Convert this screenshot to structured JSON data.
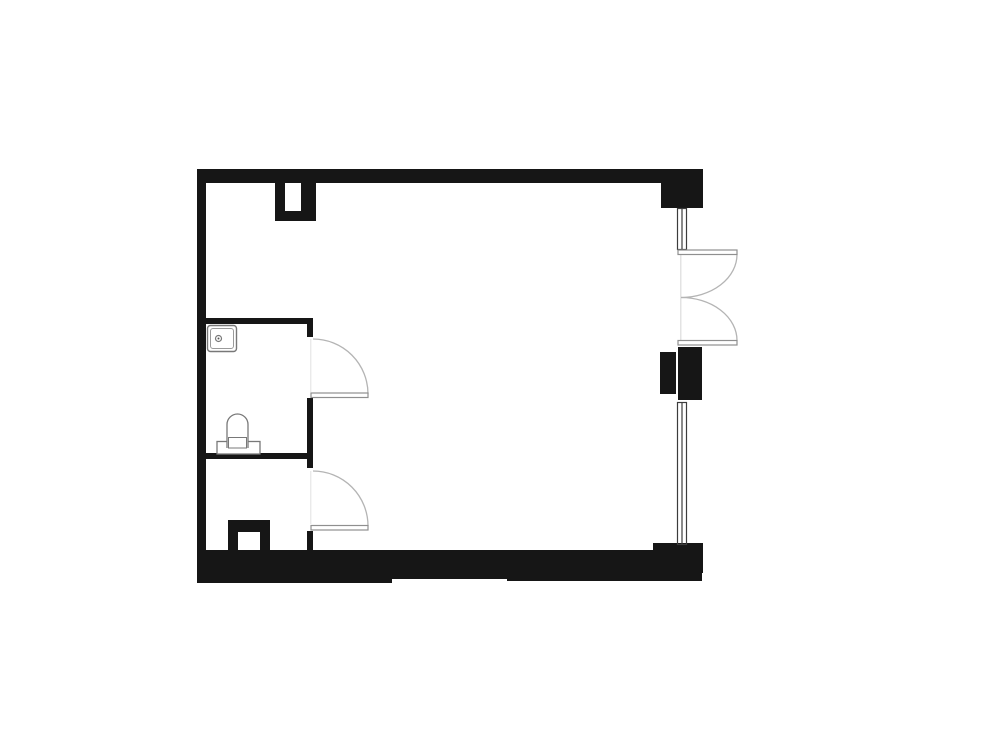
{
  "canvas": {
    "width": 1000,
    "height": 750,
    "background": "#ffffff"
  },
  "floor_plan": {
    "colors": {
      "wall": "#161616",
      "window_stroke": "#3c3c3c",
      "door_arc": "#b4b4b4",
      "door_leaf_stroke": "#8f8f8f",
      "fixture_stroke": "#787878",
      "faint_line": "#dcdcdc"
    },
    "shapes": [
      {
        "name": "top-wall",
        "type": "rect",
        "attrs": {
          "x": 197,
          "y": 169,
          "width": 506,
          "height": 14,
          "fill": "#161616"
        }
      },
      {
        "name": "top-right-corner-block",
        "type": "rect",
        "attrs": {
          "x": 661,
          "y": 169,
          "width": 42,
          "height": 39,
          "fill": "#161616"
        }
      },
      {
        "name": "left-wall",
        "type": "rect",
        "attrs": {
          "x": 197,
          "y": 169,
          "width": 9,
          "height": 414,
          "fill": "#161616"
        }
      },
      {
        "name": "bathroom-top-wall",
        "type": "rect",
        "attrs": {
          "x": 197,
          "y": 318,
          "width": 116,
          "height": 6,
          "fill": "#161616"
        }
      },
      {
        "name": "bathroom-bottom-wall",
        "type": "rect",
        "attrs": {
          "x": 197,
          "y": 453,
          "width": 116,
          "height": 6,
          "fill": "#161616"
        }
      },
      {
        "name": "partition-stub-upper",
        "type": "rect",
        "attrs": {
          "x": 307,
          "y": 318,
          "width": 6,
          "height": 19,
          "fill": "#161616"
        }
      },
      {
        "name": "partition-wall-mid",
        "type": "rect",
        "attrs": {
          "x": 307,
          "y": 398,
          "width": 6,
          "height": 70,
          "fill": "#161616"
        }
      },
      {
        "name": "partition-stub-lower",
        "type": "rect",
        "attrs": {
          "x": 307,
          "y": 531,
          "width": 6,
          "height": 21,
          "fill": "#161616"
        }
      },
      {
        "name": "duct-top-left-leg",
        "type": "rect",
        "attrs": {
          "x": 275,
          "y": 183,
          "width": 10,
          "height": 38,
          "fill": "#161616"
        }
      },
      {
        "name": "duct-top-right-leg",
        "type": "rect",
        "attrs": {
          "x": 301,
          "y": 183,
          "width": 15,
          "height": 38,
          "fill": "#161616"
        }
      },
      {
        "name": "duct-top-bottom-bar",
        "type": "rect",
        "attrs": {
          "x": 275,
          "y": 211,
          "width": 41,
          "height": 10,
          "fill": "#161616"
        }
      },
      {
        "name": "duct-bottom-cap",
        "type": "rect",
        "attrs": {
          "x": 228,
          "y": 520,
          "width": 42,
          "height": 12,
          "fill": "#161616"
        }
      },
      {
        "name": "duct-bottom-left-leg",
        "type": "rect",
        "attrs": {
          "x": 228,
          "y": 520,
          "width": 10,
          "height": 31,
          "fill": "#161616"
        }
      },
      {
        "name": "duct-bottom-right-leg",
        "type": "rect",
        "attrs": {
          "x": 260,
          "y": 520,
          "width": 10,
          "height": 31,
          "fill": "#161616"
        }
      },
      {
        "name": "right-pier-inner",
        "type": "rect",
        "attrs": {
          "x": 660,
          "y": 352,
          "width": 16,
          "height": 42,
          "fill": "#161616"
        }
      },
      {
        "name": "right-pier-outer",
        "type": "rect",
        "attrs": {
          "x": 678,
          "y": 347,
          "width": 24,
          "height": 53,
          "fill": "#161616"
        }
      },
      {
        "name": "bottom-right-corner-block",
        "type": "rect",
        "attrs": {
          "x": 653,
          "y": 543,
          "width": 50,
          "height": 30,
          "fill": "#161616"
        }
      },
      {
        "name": "bottom-wall-main",
        "type": "rect",
        "attrs": {
          "x": 197,
          "y": 550,
          "width": 458,
          "height": 23,
          "fill": "#161616"
        }
      },
      {
        "name": "bottom-wall-ledge-left",
        "type": "rect",
        "attrs": {
          "x": 197,
          "y": 572,
          "width": 195,
          "height": 11,
          "fill": "#161616"
        }
      },
      {
        "name": "bottom-wall-ledge-mid",
        "type": "rect",
        "attrs": {
          "x": 392,
          "y": 572,
          "width": 115,
          "height": 7,
          "fill": "#161616"
        }
      },
      {
        "name": "bottom-wall-ledge-right",
        "type": "rect",
        "attrs": {
          "x": 507,
          "y": 572,
          "width": 195,
          "height": 9,
          "fill": "#161616"
        }
      },
      {
        "name": "window-upper-line-left",
        "type": "line",
        "attrs": {
          "x1": 677.5,
          "y1": 208,
          "x2": 677.5,
          "y2": 250,
          "stroke": "#3c3c3c",
          "stroke-width": 1.2
        }
      },
      {
        "name": "window-upper-line-mid",
        "type": "line",
        "attrs": {
          "x1": 682,
          "y1": 208,
          "x2": 682,
          "y2": 250,
          "stroke": "#3c3c3c",
          "stroke-width": 1.2
        }
      },
      {
        "name": "window-upper-line-right",
        "type": "line",
        "attrs": {
          "x1": 686.5,
          "y1": 208,
          "x2": 686.5,
          "y2": 250,
          "stroke": "#3c3c3c",
          "stroke-width": 1.2
        }
      },
      {
        "name": "window-upper-cap-top",
        "type": "line",
        "attrs": {
          "x1": 677,
          "y1": 208.5,
          "x2": 687,
          "y2": 208.5,
          "stroke": "#3c3c3c",
          "stroke-width": 1.2
        }
      },
      {
        "name": "window-upper-cap-bottom",
        "type": "line",
        "attrs": {
          "x1": 677,
          "y1": 249.5,
          "x2": 687,
          "y2": 249.5,
          "stroke": "#3c3c3c",
          "stroke-width": 1.2
        }
      },
      {
        "name": "window-lower-line-left",
        "type": "line",
        "attrs": {
          "x1": 677.5,
          "y1": 402,
          "x2": 677.5,
          "y2": 545,
          "stroke": "#3c3c3c",
          "stroke-width": 1.2
        }
      },
      {
        "name": "window-lower-line-mid",
        "type": "line",
        "attrs": {
          "x1": 682,
          "y1": 402,
          "x2": 682,
          "y2": 545,
          "stroke": "#3c3c3c",
          "stroke-width": 1.2
        }
      },
      {
        "name": "window-lower-line-right",
        "type": "line",
        "attrs": {
          "x1": 686.5,
          "y1": 402,
          "x2": 686.5,
          "y2": 545,
          "stroke": "#3c3c3c",
          "stroke-width": 1.2
        }
      },
      {
        "name": "window-lower-cap-top",
        "type": "line",
        "attrs": {
          "x1": 677,
          "y1": 402.5,
          "x2": 687,
          "y2": 402.5,
          "stroke": "#3c3c3c",
          "stroke-width": 1.2
        }
      },
      {
        "name": "window-lower-cap-bottom",
        "type": "line",
        "attrs": {
          "x1": 677,
          "y1": 544.5,
          "x2": 687,
          "y2": 544.5,
          "stroke": "#3c3c3c",
          "stroke-width": 1.2
        }
      },
      {
        "name": "french-door-threshold-line",
        "type": "line",
        "attrs": {
          "x1": 680.8,
          "y1": 255,
          "x2": 680.8,
          "y2": 340,
          "stroke": "#dcdcdc",
          "stroke-width": 1.2
        }
      },
      {
        "name": "french-door-top-arc",
        "type": "path",
        "attrs": {
          "d": "M 737 254.5 A 56 43 0 0 1 681 297.5",
          "fill": "none",
          "stroke": "#b4b4b4",
          "stroke-width": 1.3
        }
      },
      {
        "name": "french-door-bottom-arc",
        "type": "path",
        "attrs": {
          "d": "M 737 340.5 A 56 43 0 0 0 681 297.5",
          "fill": "none",
          "stroke": "#b4b4b4",
          "stroke-width": 1.3
        }
      },
      {
        "name": "french-door-top-leaf",
        "type": "rect",
        "attrs": {
          "x": 678,
          "y": 250,
          "width": 59,
          "height": 4.5,
          "fill": "#ffffff",
          "stroke": "#8f8f8f",
          "stroke-width": 1.2
        }
      },
      {
        "name": "french-door-bottom-leaf",
        "type": "rect",
        "attrs": {
          "x": 678,
          "y": 340.5,
          "width": 59,
          "height": 4.5,
          "fill": "#ffffff",
          "stroke": "#8f8f8f",
          "stroke-width": 1.2
        }
      },
      {
        "name": "bath-door-closed-line",
        "type": "line",
        "attrs": {
          "x1": 310.8,
          "y1": 339,
          "x2": 310.8,
          "y2": 392,
          "stroke": "#e2e2e2",
          "stroke-width": 1
        }
      },
      {
        "name": "bath-door-arc",
        "type": "path",
        "attrs": {
          "d": "M 313 339 A 55 55 0 0 1 368 394",
          "fill": "none",
          "stroke": "#b4b4b4",
          "stroke-width": 1.3
        }
      },
      {
        "name": "bath-door-leaf",
        "type": "rect",
        "attrs": {
          "x": 311,
          "y": 393,
          "width": 57,
          "height": 4.5,
          "fill": "#ffffff",
          "stroke": "#8f8f8f",
          "stroke-width": 1.2
        }
      },
      {
        "name": "wc-door-closed-line",
        "type": "line",
        "attrs": {
          "x1": 310.8,
          "y1": 471,
          "x2": 310.8,
          "y2": 524,
          "stroke": "#e2e2e2",
          "stroke-width": 1
        }
      },
      {
        "name": "wc-door-arc",
        "type": "path",
        "attrs": {
          "d": "M 313 471 A 55 55 0 0 1 368 526",
          "fill": "none",
          "stroke": "#b4b4b4",
          "stroke-width": 1.3
        }
      },
      {
        "name": "wc-door-leaf",
        "type": "rect",
        "attrs": {
          "x": 311,
          "y": 525.5,
          "width": 57,
          "height": 4.5,
          "fill": "#ffffff",
          "stroke": "#8f8f8f",
          "stroke-width": 1.2
        }
      },
      {
        "name": "sink-outer",
        "type": "rect",
        "attrs": {
          "x": 207.5,
          "y": 325.5,
          "width": 29,
          "height": 26,
          "rx": 3,
          "fill": "#ffffff",
          "stroke": "#787878",
          "stroke-width": 1.4
        }
      },
      {
        "name": "sink-inner",
        "type": "rect",
        "attrs": {
          "x": 210.5,
          "y": 328.5,
          "width": 23,
          "height": 20,
          "rx": 2.5,
          "fill": "none",
          "stroke": "#9a9a9a",
          "stroke-width": 1
        }
      },
      {
        "name": "sink-drain",
        "type": "circle",
        "attrs": {
          "cx": 218.5,
          "cy": 338.5,
          "r": 3,
          "fill": "#ffffff",
          "stroke": "#787878",
          "stroke-width": 1.2
        }
      },
      {
        "name": "sink-drain-dot",
        "type": "circle",
        "attrs": {
          "cx": 218.5,
          "cy": 338.5,
          "r": 1,
          "fill": "#555555"
        }
      },
      {
        "name": "toilet-tank",
        "type": "rect",
        "attrs": {
          "x": 217,
          "y": 441.5,
          "width": 43,
          "height": 12.5,
          "fill": "#ffffff",
          "stroke": "#787878",
          "stroke-width": 1.3
        }
      },
      {
        "name": "toilet-bowl",
        "type": "path",
        "attrs": {
          "d": "M 227 448 L 227 424.5 A 10.5 10.5 0 0 1 248 424.5 L 248 448",
          "fill": "#ffffff",
          "stroke": "#787878",
          "stroke-width": 1.3
        }
      },
      {
        "name": "toilet-seat",
        "type": "rect",
        "attrs": {
          "x": 228.5,
          "y": 437.5,
          "width": 18,
          "height": 10.5,
          "fill": "#ffffff",
          "stroke": "#787878",
          "stroke-width": 1
        }
      }
    ]
  }
}
